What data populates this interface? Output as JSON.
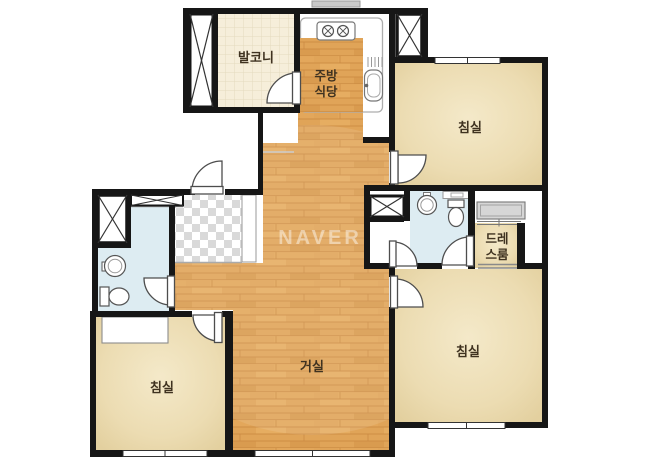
{
  "title": "apartment-floor-plan",
  "watermark": {
    "text": "NAVER"
  },
  "rooms": {
    "balcony": {
      "label": "발코니"
    },
    "kitchen_dining": {
      "label_line1": "주방",
      "label_line2": "식당"
    },
    "bedroom_top_right": {
      "label": "침실"
    },
    "dress_room": {
      "label_line1": "드레",
      "label_line2": "스룸"
    },
    "living_room": {
      "label": "거실"
    },
    "bedroom_left": {
      "label": "침실"
    },
    "bedroom_bottom_right": {
      "label": "침실"
    }
  },
  "colors": {
    "wall": "#161616",
    "wood_floor": "#e0a458",
    "wood_plank_line": "#c9883f",
    "room_floor": "#ebdab0",
    "room_floor_light": "#f4e9c9",
    "balcony_floor": "#f6eeda",
    "bathroom_floor": "#ddecf2",
    "entrance_checker": "#d9d9d9",
    "furniture_gray": "#d6d6d6",
    "background": "#ffffff"
  }
}
